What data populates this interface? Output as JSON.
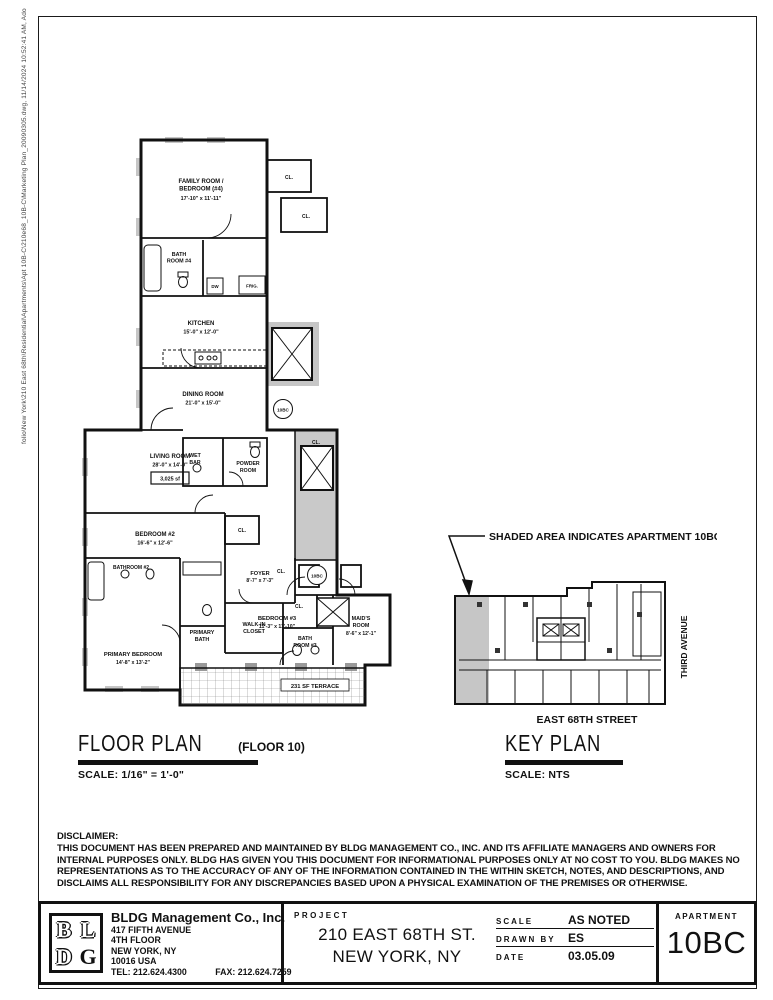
{
  "page": {
    "plot_stamp": "folio\\New York\\210 East 68th\\Residential\\Apartments\\Apt 10B-C\\210e68_10B-C\\Marketing Plan_20090305.dwg, 11/14/2024 10:52:41 AM, Adobe PDF"
  },
  "floor_plan": {
    "title": "FLOOR PLAN",
    "title_suffix": "(FLOOR 10)",
    "scale": "SCALE: 1/16\" = 1'-0\"",
    "area_label": "3,025 sf",
    "unit_tag": "10BC",
    "labels": {
      "cl": "CL.",
      "dw": "DW",
      "frig": "FRIG."
    },
    "rooms": {
      "family": {
        "name1": "FAMILY ROOM /",
        "name2": "BEDROOM (#4)",
        "dims": "17'-10\" x 11'-11\""
      },
      "bath4": {
        "name1": "BATH",
        "name2": "ROOM #4"
      },
      "kitchen": {
        "name1": "KITCHEN",
        "dims": "15'-0\" x 12'-0\""
      },
      "dining": {
        "name1": "DINING ROOM",
        "dims": "21'-0\" x 15'-0\""
      },
      "wetbar": {
        "name1": "WET",
        "name2": "BAR"
      },
      "powder": {
        "name1": "POWDER",
        "name2": "ROOM"
      },
      "living": {
        "name1": "LIVING ROOM",
        "dims": "28'-0\" x 14'-0\""
      },
      "bedroom2": {
        "name1": "BEDROOM #2",
        "dims": "16'-6\" x 12'-6\""
      },
      "bathroom2": {
        "name1": "BATHROOM #2"
      },
      "foyer": {
        "name1": "FOYER",
        "dims": "8'-7\" x 7'-3\""
      },
      "walkin": {
        "name1": "WALK-IN",
        "name2": "CLOSET"
      },
      "primary_bath": {
        "name1": "PRIMARY",
        "name2": "BATH"
      },
      "primary_bedroom": {
        "name1": "PRIMARY BEDROOM",
        "dims": "14'-8\" x 13'-2\""
      },
      "bedroom3": {
        "name1": "BEDROOM #3",
        "dims": "11'-3\" x 11'-10\""
      },
      "bath3": {
        "name1": "BATH",
        "name2": "ROOM #3"
      },
      "maids": {
        "name1": "MAID'S",
        "name2": "ROOM",
        "dims": "8'-6\" x 12'-1\""
      },
      "terrace": {
        "name1": "231 SF TERRACE"
      }
    }
  },
  "key_plan": {
    "title": "KEY PLAN",
    "scale": "SCALE: NTS",
    "annotation": "SHADED AREA INDICATES APARTMENT 10BC",
    "street_bottom": "EAST 68TH STREET",
    "street_right": "THIRD AVENUE"
  },
  "disclaimer": {
    "heading": "DISCLAIMER:",
    "lines": [
      "THIS DOCUMENT HAS BEEN PREPARED AND MAINTAINED BY BLDG MANAGEMENT CO., INC. AND ITS AFFILIATE MANAGERS AND OWNERS FOR",
      "INTERNAL PURPOSES ONLY.  BLDG HAS GIVEN YOU THIS DOCUMENT FOR INFORMATIONAL PURPOSES ONLY AT NO COST TO YOU.  BLDG MAKES NO",
      "REPRESENTATIONS AS TO THE ACCURACY OF ANY OF THE INFORMATION CONTAINED IN THE WITHIN SKETCH, NOTES, AND DESCRIPTIONS, AND",
      "DISCLAIMS ALL RESPONSIBILITY FOR ANY DISCREPANCIES BASED UPON A PHYSICAL EXAMINATION OF THE PREMISES OR OTHERWISE."
    ]
  },
  "title_block": {
    "logo": {
      "l1": "B",
      "l2": "L",
      "l3": "D",
      "l4": "G"
    },
    "company": {
      "name": "BLDG Management Co., Inc.",
      "address1": "417 FIFTH AVENUE",
      "address2": "4TH FLOOR",
      "address3": "NEW YORK, NY",
      "address4": "10016 USA",
      "tel": "TEL: 212.624.4300",
      "fax": "FAX: 212.624.7259"
    },
    "project": {
      "label": "PROJECT",
      "line1": "210 EAST 68TH ST.",
      "line2": "NEW YORK, NY"
    },
    "meta": {
      "scale_label": "SCALE",
      "scale_value": "AS NOTED",
      "drawn_label": "DRAWN BY",
      "drawn_value": "ES",
      "date_label": "DATE",
      "date_value": "03.05.09"
    },
    "apartment": {
      "label": "APARTMENT",
      "number": "10BC"
    }
  },
  "colors": {
    "ink": "#111111",
    "shade": "#c6c6c6"
  }
}
